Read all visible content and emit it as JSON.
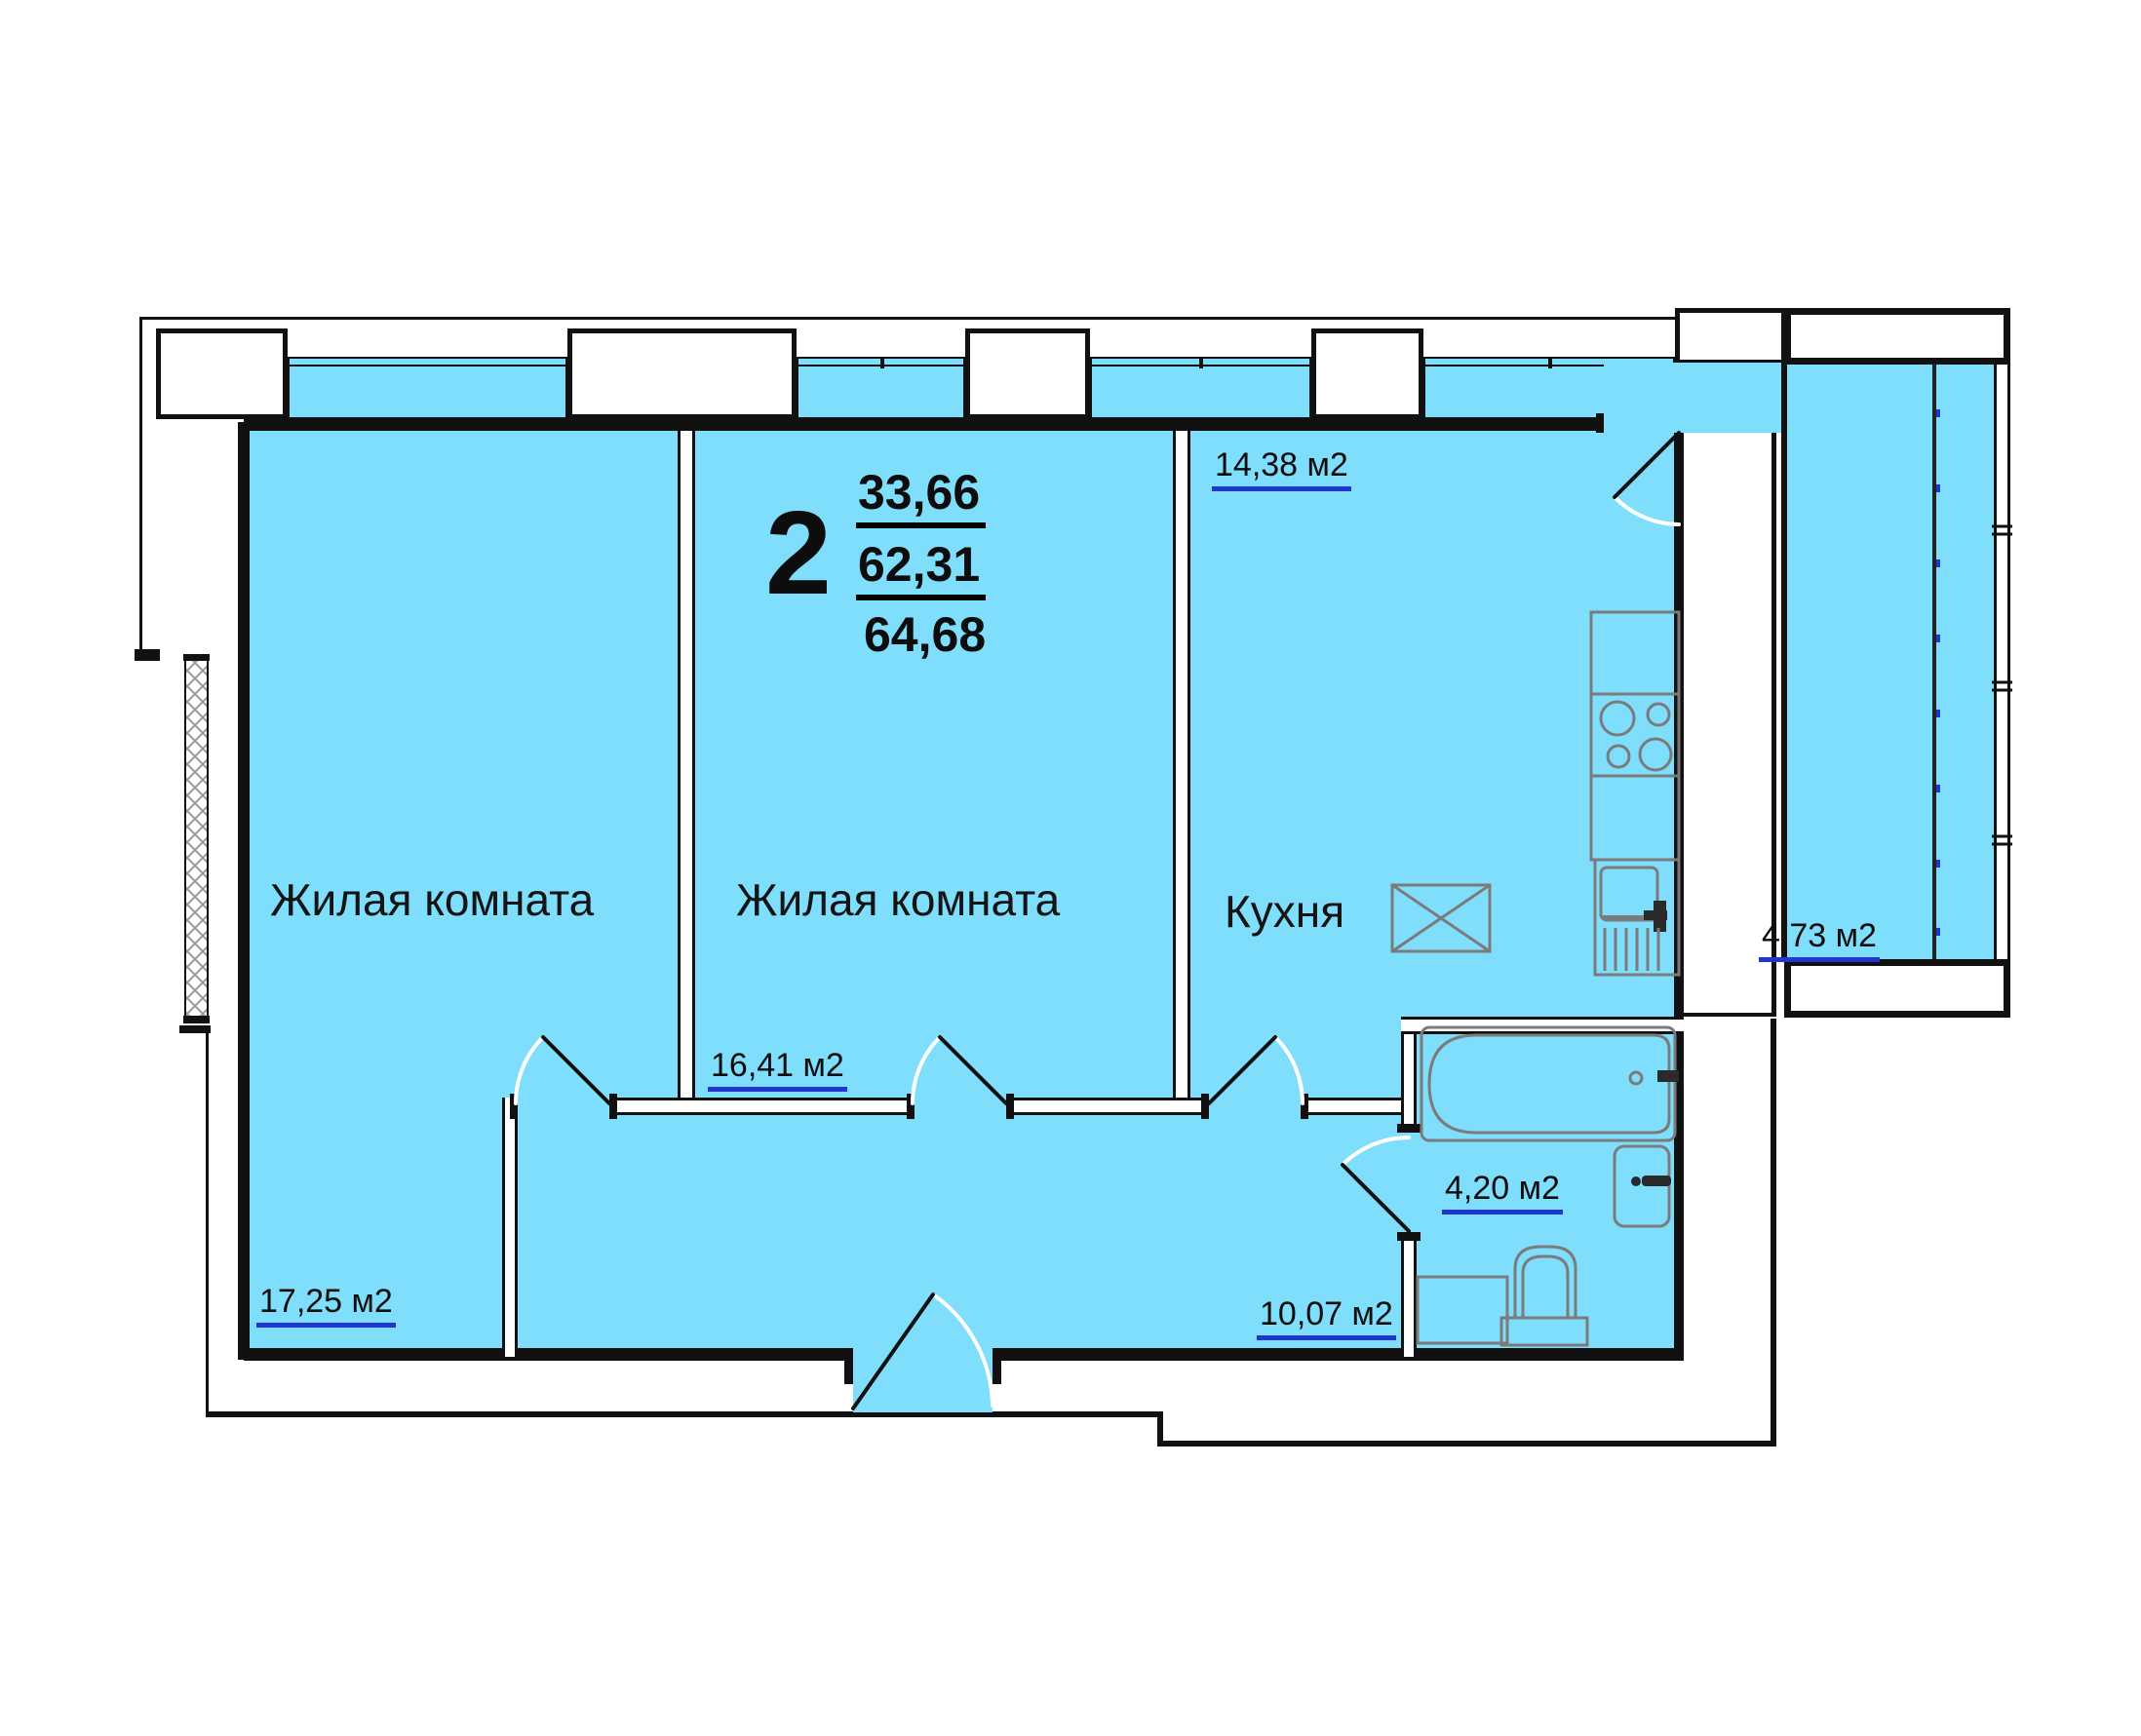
{
  "plan": {
    "summary": {
      "rooms_count": "2",
      "living_area": "33,66",
      "apartment_area": "62,31",
      "total_area": "64,68"
    },
    "rooms": [
      {
        "name": "Жилая комната",
        "area": "17,25 м2"
      },
      {
        "name": "Жилая комната",
        "area": "16,41 м2"
      },
      {
        "name": "Кухня",
        "area": "14,38 м2"
      },
      {
        "area": "4,20 м2"
      },
      {
        "area": "10,07 м2"
      },
      {
        "area": "4,73 м2"
      }
    ],
    "colors": {
      "room_fill": "#7EDEFB",
      "area_underline": "#2135CF",
      "wall": "#111111",
      "fixture": "#7B7B7B"
    }
  }
}
